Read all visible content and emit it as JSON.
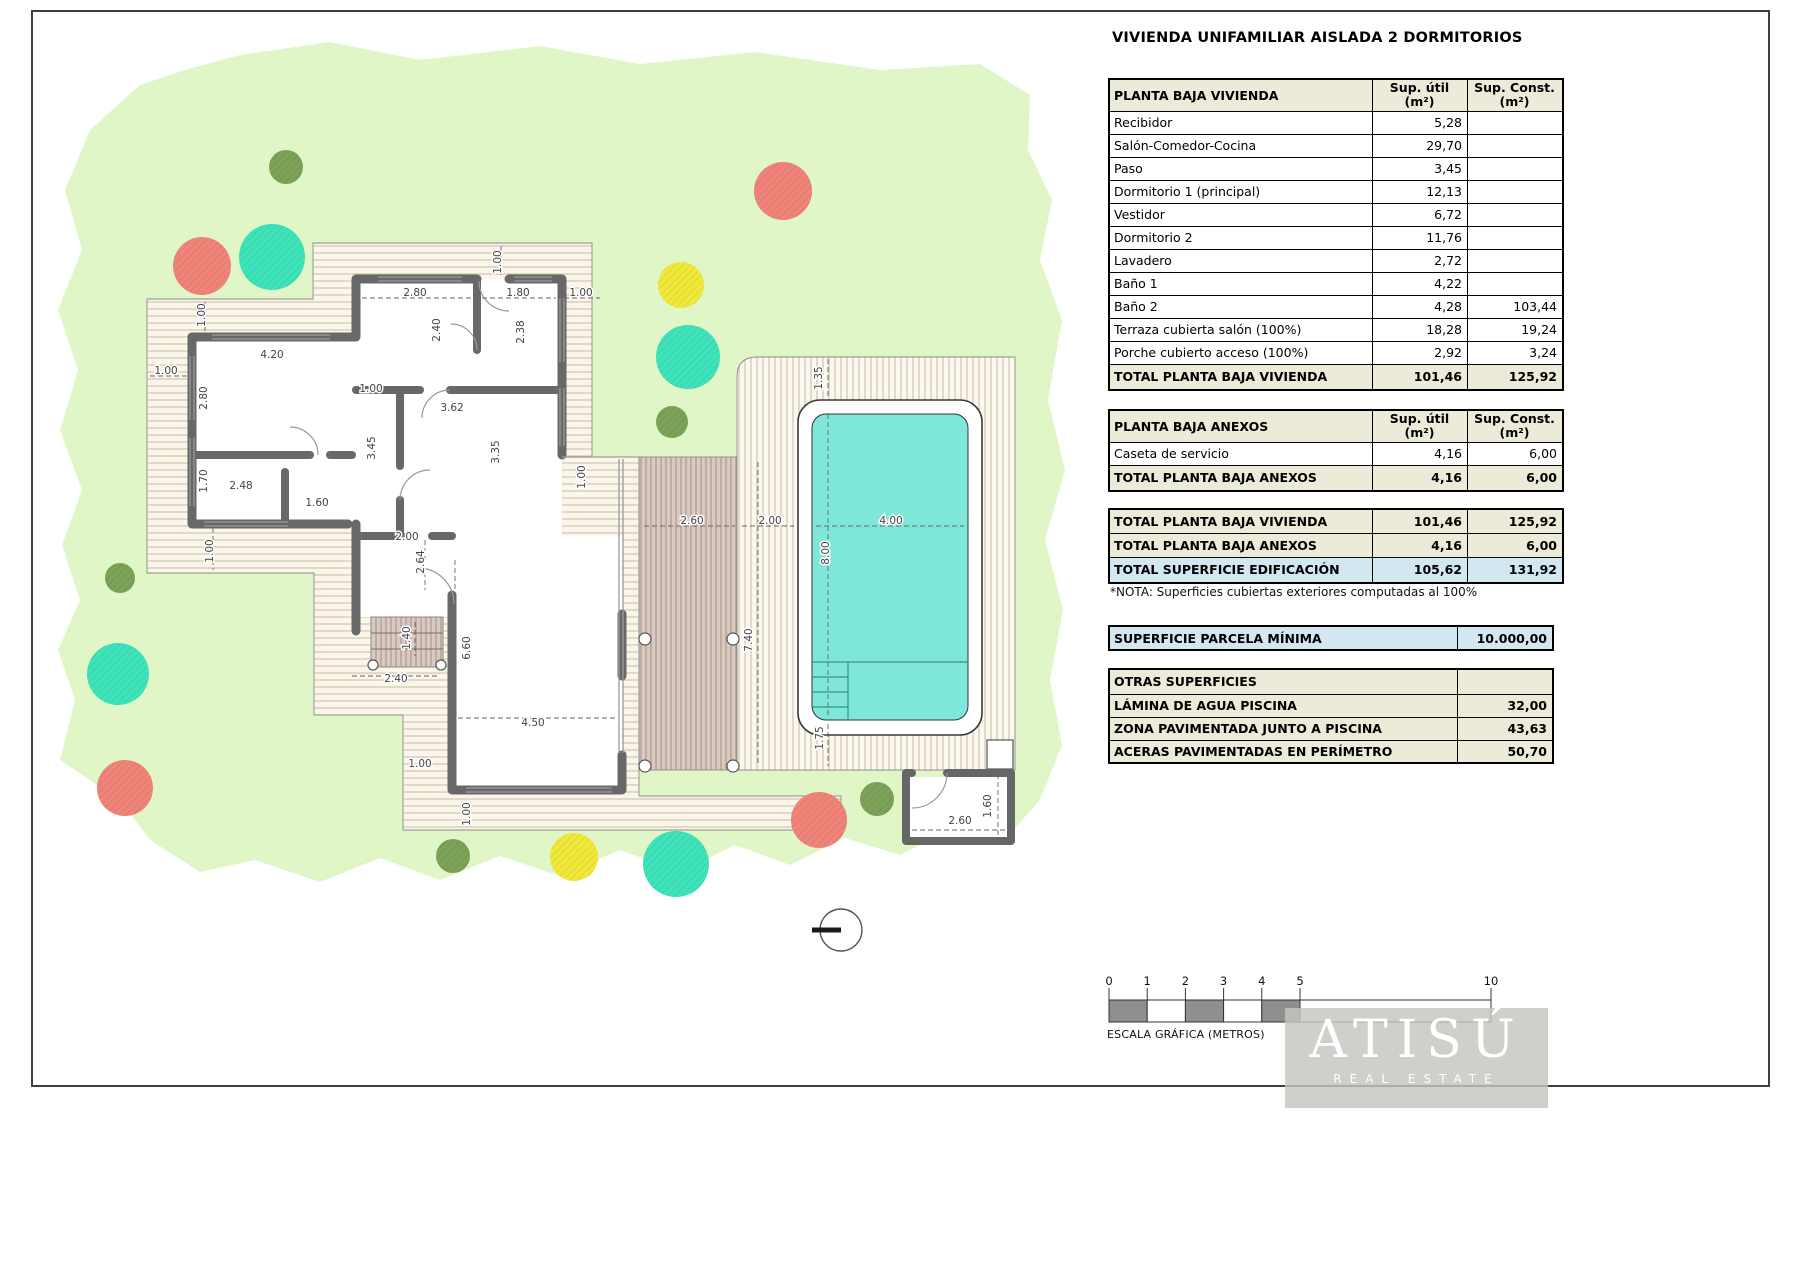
{
  "title": "VIVIENDA UNIFAMILIAR AISLADA 2 DORMITORIOS",
  "tables": {
    "vivienda": {
      "header": "PLANTA BAJA VIVIENDA",
      "col_util_l1": "Sup. útil",
      "col_util_l2": "(m²)",
      "col_const_l1": "Sup. Const.",
      "col_const_l2": "(m²)",
      "rows": [
        {
          "label": "Recibidor",
          "util": "5,28",
          "const": ""
        },
        {
          "label": "Salón-Comedor-Cocina",
          "util": "29,70",
          "const": ""
        },
        {
          "label": "Paso",
          "util": "3,45",
          "const": ""
        },
        {
          "label": "Dormitorio 1 (principal)",
          "util": "12,13",
          "const": ""
        },
        {
          "label": "Vestidor",
          "util": "6,72",
          "const": ""
        },
        {
          "label": "Dormitorio 2",
          "util": "11,76",
          "const": ""
        },
        {
          "label": "Lavadero",
          "util": "2,72",
          "const": ""
        },
        {
          "label": "Baño 1",
          "util": "4,22",
          "const": ""
        },
        {
          "label": "Baño 2",
          "util": "4,28",
          "const": "103,44"
        },
        {
          "label": "Terraza cubierta salón (100%)",
          "util": "18,28",
          "const": "19,24"
        },
        {
          "label": "Porche cubierto acceso (100%)",
          "util": "2,92",
          "const": "3,24"
        }
      ],
      "total": {
        "label": "TOTAL PLANTA BAJA VIVIENDA",
        "util": "101,46",
        "const": "125,92"
      }
    },
    "anexos": {
      "header": "PLANTA BAJA ANEXOS",
      "col_util_l1": "Sup. útil",
      "col_util_l2": "(m²)",
      "col_const_l1": "Sup. Const.",
      "col_const_l2": "(m²)",
      "rows": [
        {
          "label": "Caseta de servicio",
          "util": "4,16",
          "const": "6,00"
        }
      ],
      "total": {
        "label": "TOTAL PLANTA BAJA ANEXOS",
        "util": "4,16",
        "const": "6,00"
      }
    },
    "summary": [
      {
        "label": "TOTAL PLANTA BAJA VIVIENDA",
        "util": "101,46",
        "const": "125,92",
        "blue": false
      },
      {
        "label": "TOTAL PLANTA BAJA ANEXOS",
        "util": "4,16",
        "const": "6,00",
        "blue": false
      },
      {
        "label": "TOTAL SUPERFICIE EDIFICACIÓN",
        "util": "105,62",
        "const": "131,92",
        "blue": true
      }
    ],
    "nota": "*NOTA: Superficies cubiertas exteriores computadas al 100%",
    "parcela": {
      "label": "SUPERFICIE PARCELA MÍNIMA",
      "value": "10.000,00"
    },
    "otras": {
      "header": "OTRAS SUPERFICIES",
      "rows": [
        {
          "label": "LÁMINA DE AGUA PISCINA",
          "value": "32,00"
        },
        {
          "label": "ZONA PAVIMENTADA JUNTO A PISCINA",
          "value": "43,63"
        },
        {
          "label": "ACERAS PAVIMENTADAS EN PERÍMETRO",
          "value": "50,70"
        }
      ]
    }
  },
  "plan": {
    "colors": {
      "grass": "#e1f6c6",
      "deck_bg": "#faf6ec",
      "deck_line": "#c9b99f",
      "pooldeck_bg": "#fbf8f0",
      "pooldeck_line": "#cbbaa0",
      "terrace_bg": "#d8cac2",
      "terrace_line": "#a9907f",
      "wall": "#686868",
      "water": "#7ee7da",
      "tree_red": "#f08478",
      "tree_teal": "#3fe3ba",
      "tree_yellow": "#f0e83a",
      "tree_olive": "#7ca257"
    },
    "dims": [
      {
        "t": "1.00",
        "x": 501,
        "y": 262,
        "r": -90
      },
      {
        "t": "2.80",
        "x": 415,
        "y": 296,
        "r": 0
      },
      {
        "t": "1.80",
        "x": 518,
        "y": 296,
        "r": 0
      },
      {
        "t": "1.00",
        "x": 581,
        "y": 296,
        "r": 0
      },
      {
        "t": "2.40",
        "x": 440,
        "y": 330,
        "r": -90
      },
      {
        "t": "2.38",
        "x": 524,
        "y": 332,
        "r": -90
      },
      {
        "t": "4.20",
        "x": 272,
        "y": 358,
        "r": 0
      },
      {
        "t": "1.00",
        "x": 205,
        "y": 315,
        "r": -90
      },
      {
        "t": "1.00",
        "x": 166,
        "y": 374,
        "r": 0
      },
      {
        "t": "2.80",
        "x": 207,
        "y": 398,
        "r": -90
      },
      {
        "t": "1.00",
        "x": 371,
        "y": 392,
        "r": 0
      },
      {
        "t": "3.62",
        "x": 452,
        "y": 411,
        "r": 0
      },
      {
        "t": "3.45",
        "x": 375,
        "y": 448,
        "r": -90
      },
      {
        "t": "3.35",
        "x": 499,
        "y": 452,
        "r": -90
      },
      {
        "t": "1.70",
        "x": 207,
        "y": 481,
        "r": -90
      },
      {
        "t": "2.48",
        "x": 241,
        "y": 489,
        "r": 0
      },
      {
        "t": "1.60",
        "x": 317,
        "y": 506,
        "r": 0
      },
      {
        "t": "2.00",
        "x": 407,
        "y": 540,
        "r": 0
      },
      {
        "t": "2.64",
        "x": 424,
        "y": 562,
        "r": -90
      },
      {
        "t": "1.00",
        "x": 213,
        "y": 551,
        "r": -90
      },
      {
        "t": "1.00",
        "x": 585,
        "y": 477,
        "r": -90
      },
      {
        "t": "6.60",
        "x": 470,
        "y": 648,
        "r": -90
      },
      {
        "t": "4.50",
        "x": 533,
        "y": 726,
        "r": 0
      },
      {
        "t": "1.40",
        "x": 410,
        "y": 638,
        "r": -90
      },
      {
        "t": "2.40",
        "x": 396,
        "y": 682,
        "r": 0
      },
      {
        "t": "1.00",
        "x": 420,
        "y": 767,
        "r": 0
      },
      {
        "t": "1.00",
        "x": 470,
        "y": 814,
        "r": -90
      },
      {
        "t": "7.40",
        "x": 752,
        "y": 640,
        "r": -90
      },
      {
        "t": "2.60",
        "x": 692,
        "y": 524,
        "r": 0
      },
      {
        "t": "2.00",
        "x": 770,
        "y": 524,
        "r": 0
      },
      {
        "t": "4.00",
        "x": 891,
        "y": 524,
        "r": 0
      },
      {
        "t": "8.00",
        "x": 829,
        "y": 553,
        "r": -90
      },
      {
        "t": "1.35",
        "x": 822,
        "y": 378,
        "r": -90
      },
      {
        "t": "1.75",
        "x": 823,
        "y": 738,
        "r": -90
      },
      {
        "t": "2.60",
        "x": 960,
        "y": 824,
        "r": 0
      },
      {
        "t": "1.60",
        "x": 991,
        "y": 806,
        "r": -90
      }
    ],
    "dim_lines": [
      [
        828,
        359,
        828,
        396
      ],
      [
        828,
        414,
        828,
        716
      ],
      [
        816,
        526,
        964,
        526
      ],
      [
        828,
        724,
        828,
        766
      ],
      [
        742,
        526,
        794,
        526
      ],
      [
        644,
        526,
        735,
        526
      ],
      [
        758,
        462,
        758,
        766
      ],
      [
        458,
        718,
        616,
        718
      ],
      [
        455,
        560,
        455,
        768
      ],
      [
        352,
        676,
        438,
        676
      ],
      [
        415,
        622,
        415,
        656
      ],
      [
        912,
        830,
        1006,
        830
      ],
      [
        998,
        774,
        998,
        836
      ],
      [
        362,
        298,
        473,
        298
      ],
      [
        482,
        298,
        556,
        298
      ],
      [
        564,
        298,
        600,
        298
      ],
      [
        205,
        302,
        205,
        334
      ],
      [
        150,
        376,
        188,
        376
      ],
      [
        213,
        528,
        213,
        570
      ],
      [
        501,
        246,
        501,
        278
      ],
      [
        425,
        540,
        425,
        590
      ]
    ],
    "trees": [
      {
        "c": "olive",
        "x": 286,
        "y": 167,
        "r": 17
      },
      {
        "c": "red",
        "x": 783,
        "y": 191,
        "r": 29
      },
      {
        "c": "red",
        "x": 202,
        "y": 266,
        "r": 29
      },
      {
        "c": "teal",
        "x": 272,
        "y": 257,
        "r": 33
      },
      {
        "c": "yellow",
        "x": 681,
        "y": 285,
        "r": 23
      },
      {
        "c": "teal",
        "x": 688,
        "y": 357,
        "r": 32
      },
      {
        "c": "olive",
        "x": 672,
        "y": 422,
        "r": 16
      },
      {
        "c": "olive",
        "x": 120,
        "y": 578,
        "r": 15
      },
      {
        "c": "teal",
        "x": 118,
        "y": 674,
        "r": 31
      },
      {
        "c": "red",
        "x": 125,
        "y": 788,
        "r": 28
      },
      {
        "c": "olive",
        "x": 453,
        "y": 856,
        "r": 17
      },
      {
        "c": "yellow",
        "x": 574,
        "y": 857,
        "r": 24
      },
      {
        "c": "teal",
        "x": 676,
        "y": 864,
        "r": 33
      },
      {
        "c": "red",
        "x": 819,
        "y": 820,
        "r": 28
      },
      {
        "c": "olive",
        "x": 877,
        "y": 799,
        "r": 17
      }
    ]
  },
  "scalebar": {
    "ticks": [
      {
        "m": 0,
        "t": "0"
      },
      {
        "m": 1,
        "t": "1"
      },
      {
        "m": 2,
        "t": "2"
      },
      {
        "m": 3,
        "t": "3"
      },
      {
        "m": 4,
        "t": "4"
      },
      {
        "m": 5,
        "t": "5"
      },
      {
        "m": 10,
        "t": "10"
      }
    ],
    "label": "ESCALA GRÁFICA (METROS)"
  },
  "logo": {
    "name": "ATISÚ",
    "tagline": "REAL ESTATE"
  }
}
